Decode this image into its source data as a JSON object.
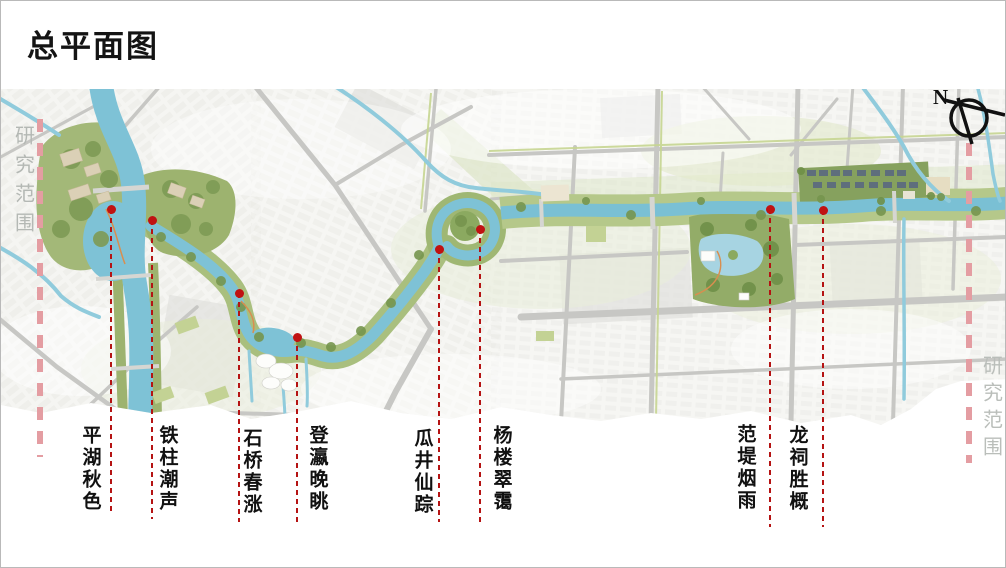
{
  "slide": {
    "title": "总平面图"
  },
  "compass": {
    "label": "N"
  },
  "study_area": {
    "left_label": "研究范围",
    "right_label": "研究范围",
    "boundary_color": "#e49da2"
  },
  "landmarks": [
    {
      "name": "平湖秋色"
    },
    {
      "name": "铁柱潮声"
    },
    {
      "name": "石桥春涨"
    },
    {
      "name": "登瀛晚眺"
    },
    {
      "name": "瓜井仙踪"
    },
    {
      "name": "杨楼翠霭"
    },
    {
      "name": "范堤烟雨"
    },
    {
      "name": "龙祠胜概"
    }
  ],
  "colors": {
    "river_blue": "#7ec2d6",
    "park_green": "#93ac68",
    "road_gray": "#c7c7c4",
    "marker_red": "#c01212",
    "boundary_pink": "#e49da2",
    "label_text": "#111111"
  }
}
